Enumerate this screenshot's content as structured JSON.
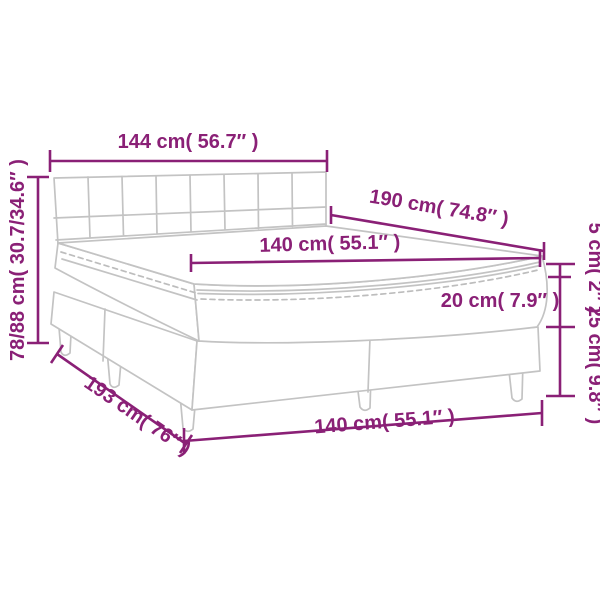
{
  "diagram": {
    "title": "box-spring-bed-dimension-diagram",
    "colors": {
      "dimension": "#8A2076",
      "artwork": "#c3c3c3",
      "background": "#ffffff"
    },
    "dimensions": {
      "headboard_width": "144 cm( 56.7″ )",
      "total_height": "78/88 cm( 30.7/34.6″ )",
      "bed_length": "190 cm( 74.8″ )",
      "mattress_width_top": "140 cm( 55.1″ )",
      "topper_height": "5 cm( 2″ )",
      "mattress_height": "20 cm( 7.9″ )",
      "base_height": "25 cm( 9.8″ )",
      "total_length": "193 cm( 76″ )",
      "bed_width_bottom": "140 cm( 55.1″ )"
    }
  }
}
